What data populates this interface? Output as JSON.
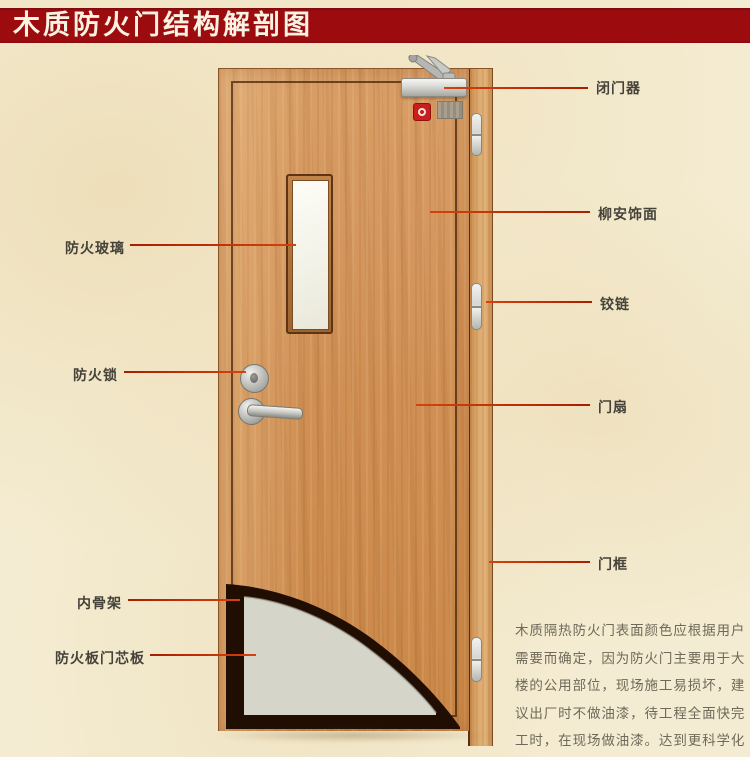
{
  "title": "木质防火门结构解剖图",
  "annotations": {
    "left": [
      {
        "id": "fire-glass",
        "text": "防火玻璃"
      },
      {
        "id": "fire-lock",
        "text": "防火锁"
      },
      {
        "id": "inner-skeleton",
        "text": "内骨架"
      },
      {
        "id": "fire-board-core",
        "text": "防火板门芯板"
      }
    ],
    "right": [
      {
        "id": "door-closer",
        "text": "闭门器"
      },
      {
        "id": "lauan-veneer",
        "text": "柳安饰面"
      },
      {
        "id": "hinge",
        "text": "铰链"
      },
      {
        "id": "door-leaf",
        "text": "门扇"
      },
      {
        "id": "door-frame",
        "text": "门框"
      }
    ]
  },
  "description": "木质隔热防火门表面颜色应根据用户需要而确定，因为防火门主要用于大楼的公用部位，现场施工易损坏，建议出厂时不做油漆，待工程全面快完工时，在现场做油漆。达到更科学化更人性化的服务。",
  "colors": {
    "banner": "#9c0c0f",
    "banner_text": "#f8f3e2",
    "background": "#f4ecd2",
    "door_wood": "#d09054",
    "frame_wood": "#dcaa6e",
    "leader_line": "#d8400e",
    "core_panel": "#d6d5ca",
    "skeleton_dark": "#200e03",
    "label_text": "#45423a",
    "description_text": "#6e6959"
  }
}
